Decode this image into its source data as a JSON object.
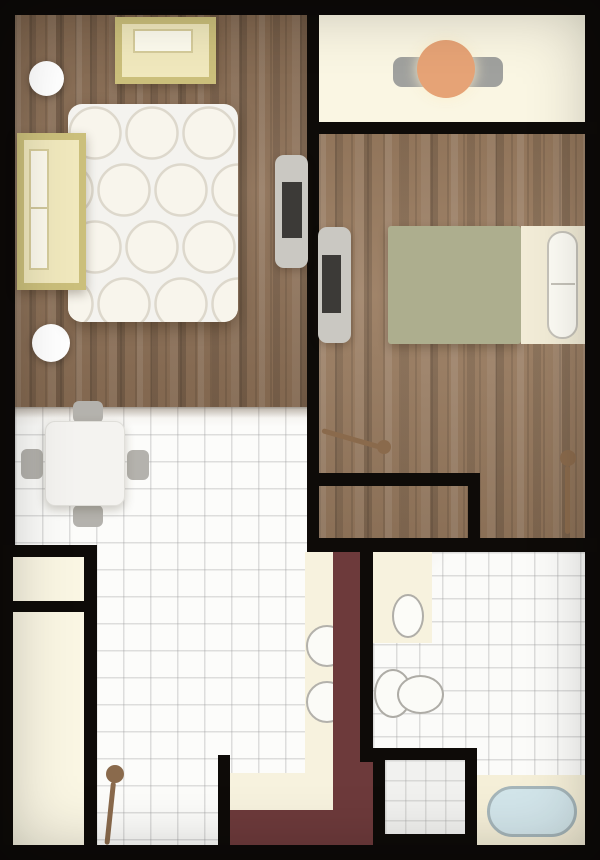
{
  "canvas": {
    "width": 600,
    "height": 860,
    "frame_color": "#0d0a08"
  },
  "palette": {
    "wall": "#0e0b08",
    "wood_living": "#8d7056",
    "wood_bedroom": "#9a7c60",
    "tile": "#fcfcfa",
    "cream_floor": "#faf6e3",
    "counter_cream": "#f7f2de",
    "accent_maroon": "#6d3a3b",
    "furniture_yellow": "#f0e8bd",
    "furniture_yellow_trim": "#cbbf7b",
    "blanket_olive": "#adae8e",
    "table_orange": "#e6a376",
    "gray_seat": "#a0a19e",
    "tv_gray": "#cac8c2",
    "tv_screen": "#3c3a37",
    "tub_blue": "#d2e5ea",
    "door_brown": "#8a6a4c"
  },
  "elements": [
    {
      "name": "living-room-floor",
      "class": "wood-a",
      "x": 15,
      "y": 15,
      "w": 292,
      "h": 392
    },
    {
      "name": "kitchen-dining-floor",
      "class": "tile-a",
      "x": 15,
      "y": 407,
      "w": 358,
      "h": 438
    },
    {
      "name": "wood-tile-transition-shadow",
      "x": 15,
      "y": 407,
      "w": 292,
      "h": 11,
      "fill": "linear-gradient(180deg, rgba(60,40,20,0.30), rgba(60,40,20,0))"
    },
    {
      "name": "balcony-floor",
      "x": 319,
      "y": 15,
      "w": 266,
      "h": 107,
      "fill": "#faf6e3"
    },
    {
      "name": "bedroom-floor",
      "class": "wood-b",
      "x": 319,
      "y": 134,
      "w": 266,
      "h": 404
    },
    {
      "name": "bathroom-floor",
      "class": "tile-b",
      "x": 373,
      "y": 552,
      "w": 212,
      "h": 293
    },
    {
      "name": "closet-block-walls",
      "x": 3,
      "y": 545,
      "w": 94,
      "h": 300,
      "fill": "#0e0b08"
    },
    {
      "name": "closet-upper-interior",
      "x": 13,
      "y": 557,
      "w": 71,
      "h": 44,
      "fill": "#faf6e3"
    },
    {
      "name": "closet-lower-interior",
      "x": 13,
      "y": 612,
      "w": 71,
      "h": 233,
      "fill": "#faf6e3"
    },
    {
      "name": "kitchen-counter-vertical",
      "x": 305,
      "y": 552,
      "w": 28,
      "h": 260,
      "fill": "#f7f2de"
    },
    {
      "name": "kitchen-counter-horizontal",
      "x": 230,
      "y": 773,
      "w": 103,
      "h": 39,
      "fill": "#f7f2de"
    },
    {
      "name": "kitchen-sink-basin-upper",
      "x": 306,
      "y": 625,
      "w": 42,
      "h": 42,
      "fill": "#fbfbf7",
      "border": "2.5px solid #b3b1ab",
      "radius": "50%"
    },
    {
      "name": "kitchen-sink-basin-lower",
      "x": 306,
      "y": 681,
      "w": 42,
      "h": 42,
      "fill": "#fbfbf7",
      "border": "2.5px solid #b3b1ab",
      "radius": "50%"
    },
    {
      "name": "accent-wall-vertical",
      "x": 333,
      "y": 552,
      "w": 27,
      "h": 293,
      "fill": "#6d3a3b"
    },
    {
      "name": "accent-wall-horizontal",
      "x": 230,
      "y": 810,
      "w": 130,
      "h": 35,
      "fill": "#6d3a3b"
    },
    {
      "name": "accent-wall-lower-patch",
      "x": 360,
      "y": 762,
      "w": 13,
      "h": 83,
      "fill": "#6d3a3b"
    },
    {
      "name": "wall-living-bedroom",
      "x": 307,
      "y": 15,
      "w": 12,
      "h": 537,
      "fill": "#0e0b08"
    },
    {
      "name": "wall-balcony-bottom",
      "x": 307,
      "y": 122,
      "w": 290,
      "h": 12,
      "fill": "#0e0b08"
    },
    {
      "name": "wall-bedroom-interior",
      "x": 319,
      "y": 473,
      "w": 161,
      "h": 13,
      "fill": "#0e0b08"
    },
    {
      "name": "wall-alcove-right",
      "x": 468,
      "y": 486,
      "w": 12,
      "h": 66,
      "fill": "#0e0b08"
    },
    {
      "name": "wall-south-of-bedroom",
      "x": 307,
      "y": 538,
      "w": 290,
      "h": 14,
      "fill": "#0e0b08"
    },
    {
      "name": "wall-bathroom-left",
      "x": 360,
      "y": 552,
      "w": 13,
      "h": 210,
      "fill": "#0e0b08"
    },
    {
      "name": "wall-entry",
      "x": 218,
      "y": 755,
      "w": 12,
      "h": 90,
      "fill": "#0e0b08"
    },
    {
      "name": "shower-enclosure",
      "x": 373,
      "y": 748,
      "w": 104,
      "h": 97,
      "fill": "#0e0b08"
    },
    {
      "name": "shower-tray",
      "class": "tile-c",
      "x": 385,
      "y": 760,
      "w": 80,
      "h": 74
    },
    {
      "name": "bathroom-counter",
      "x": 373,
      "y": 552,
      "w": 59,
      "h": 91,
      "fill": "#f7f2de"
    },
    {
      "name": "bathroom-sink",
      "x": 392,
      "y": 594,
      "w": 32,
      "h": 44,
      "fill": "#fcfcf8",
      "border": "2.5px solid #b0aea8",
      "radius": "50%"
    },
    {
      "name": "toilet-bowl",
      "x": 374,
      "y": 669,
      "w": 38,
      "h": 49,
      "fill": "#fbfbf7",
      "border": "2.5px solid #aeaca6",
      "radius": "50%"
    },
    {
      "name": "toilet-tank",
      "x": 397,
      "y": 675,
      "w": 47,
      "h": 39,
      "fill": "#fbfbf7",
      "border": "2.5px solid #aeaca6",
      "radius": "50%"
    },
    {
      "name": "bathtub-surround",
      "x": 477,
      "y": 775,
      "w": 108,
      "h": 70,
      "fill": "#f5efd8"
    },
    {
      "name": "bathtub",
      "x": 487,
      "y": 786,
      "w": 90,
      "h": 51,
      "fill": "#d2e5ea",
      "border": "3px solid #a6b6ba",
      "radius": "26px"
    },
    {
      "name": "bedroom-bed-blanket",
      "x": 388,
      "y": 226,
      "w": 133,
      "h": 118,
      "fill": "#adae8e",
      "radius": "3px",
      "shadow": "0 4px 10px rgba(40,25,10,0.28)"
    },
    {
      "name": "bedroom-bed-headboard",
      "x": 521,
      "y": 226,
      "w": 64,
      "h": 118,
      "fill": "#f2ecd7"
    },
    {
      "name": "bedroom-bed-pillow",
      "x": 547,
      "y": 231,
      "w": 31,
      "h": 108,
      "fill": "#fdfcf5",
      "border": "2px solid #c6c3ba",
      "radius": "15px"
    },
    {
      "name": "bedroom-bed-pillow-divider",
      "x": 551,
      "y": 283,
      "w": 24,
      "h": 2,
      "fill": "#c6c3ba"
    },
    {
      "name": "bedroom-tv-body",
      "x": 318,
      "y": 227,
      "w": 33,
      "h": 116,
      "fill": "#cac8c2",
      "radius": "9px",
      "shadow": "0 3px 8px rgba(40,25,10,0.25)"
    },
    {
      "name": "bedroom-tv-screen",
      "x": 322,
      "y": 255,
      "w": 19,
      "h": 58,
      "fill": "#3c3a37"
    },
    {
      "name": "bedroom-door-leaf",
      "x": 322,
      "y": 428,
      "w": 64,
      "h": 5,
      "fill": "#8a6a4c",
      "radius": "3px",
      "rotate": 16,
      "origin": "left center"
    },
    {
      "name": "bedroom-door-knob",
      "x": 377,
      "y": 440,
      "w": 14,
      "h": 14,
      "fill": "#8a6a4c",
      "radius": "50%"
    },
    {
      "name": "bedroom-door2-leaf",
      "x": 565,
      "y": 466,
      "w": 5,
      "h": 68,
      "fill": "#8a6a4c",
      "radius": "3px"
    },
    {
      "name": "bedroom-door2-knob",
      "x": 560,
      "y": 450,
      "w": 16,
      "h": 16,
      "fill": "#8a6a4c",
      "radius": "50%"
    },
    {
      "name": "balcony-chairs",
      "x": 393,
      "y": 57,
      "w": 110,
      "h": 30,
      "fill": "#a0a19e",
      "radius": "9px"
    },
    {
      "name": "balcony-round-table",
      "x": 417,
      "y": 40,
      "w": 58,
      "h": 58,
      "fill": "#e6a376",
      "radius": "50%",
      "shadow": "0 0 14px rgba(250,238,205,0.95)"
    },
    {
      "name": "living-lamp-upper",
      "x": 29,
      "y": 61,
      "w": 35,
      "h": 35,
      "fill": "#ffffff",
      "radius": "50%",
      "shadow": "0 2px 8px rgba(0,0,0,0.28)"
    },
    {
      "name": "living-lamp-lower",
      "x": 32,
      "y": 324,
      "w": 38,
      "h": 38,
      "fill": "#ffffff",
      "radius": "50%",
      "shadow": "0 2px 8px rgba(0,0,0,0.28)"
    },
    {
      "name": "living-bed",
      "x": 68,
      "y": 104,
      "w": 170,
      "h": 218,
      "fill": "#f4f3ef",
      "radius": "14px",
      "texture": "circles",
      "shadow": "0 6px 16px rgba(40,25,10,0.35)"
    },
    {
      "name": "wardrobe",
      "x": 17,
      "y": 133,
      "w": 69,
      "h": 157,
      "fill": "#f0e8bd",
      "border": "7px solid #cbbf7b",
      "shadow": "0 4px 10px rgba(40,25,10,0.30)"
    },
    {
      "name": "wardrobe-door-panel",
      "x": 29,
      "y": 149,
      "w": 20,
      "h": 121,
      "fill": "#fcf9ec",
      "border": "2px solid #d6cc9b"
    },
    {
      "name": "wardrobe-panel-divider",
      "x": 31,
      "y": 207,
      "w": 16,
      "h": 2,
      "fill": "#d0c79b"
    },
    {
      "name": "nightstand",
      "x": 115,
      "y": 17,
      "w": 101,
      "h": 67,
      "fill": "#f0e8bd",
      "border": "7px solid #cbbf7b",
      "shadow": "0 4px 10px rgba(40,25,10,0.30)"
    },
    {
      "name": "nightstand-drawer",
      "x": 133,
      "y": 29,
      "w": 60,
      "h": 24,
      "fill": "#fdfbee",
      "border": "2px solid #d6cc9b"
    },
    {
      "name": "living-tv-body",
      "x": 275,
      "y": 155,
      "w": 33,
      "h": 113,
      "fill": "#cac8c2",
      "radius": "9px",
      "shadow": "0 3px 8px rgba(40,25,10,0.25)"
    },
    {
      "name": "living-tv-screen",
      "x": 282,
      "y": 182,
      "w": 20,
      "h": 56,
      "fill": "#3c3a37"
    },
    {
      "name": "dining-chair-top",
      "x": 73,
      "y": 401,
      "w": 30,
      "h": 22,
      "fill": "#b4b2ad",
      "radius": "6px"
    },
    {
      "name": "dining-chair-bottom",
      "x": 73,
      "y": 505,
      "w": 30,
      "h": 22,
      "fill": "#b4b2ad",
      "radius": "6px"
    },
    {
      "name": "dining-chair-left",
      "x": 21,
      "y": 449,
      "w": 22,
      "h": 30,
      "fill": "#b4b2ad",
      "radius": "6px"
    },
    {
      "name": "dining-chair-right",
      "x": 127,
      "y": 450,
      "w": 22,
      "h": 30,
      "fill": "#b4b2ad",
      "radius": "6px"
    },
    {
      "name": "dining-table",
      "x": 45,
      "y": 421,
      "w": 80,
      "h": 85,
      "fill": "#f4f3f0",
      "radius": "10px",
      "border": "1px solid #e0dfda",
      "shadow": "0 4px 10px rgba(60,50,30,0.25)"
    },
    {
      "name": "entry-door-knob",
      "x": 106,
      "y": 765,
      "w": 18,
      "h": 18,
      "fill": "#8a6a4c",
      "radius": "50%"
    },
    {
      "name": "entry-door-leaf",
      "x": 111,
      "y": 782,
      "w": 5,
      "h": 63,
      "fill": "#8a6a4c",
      "radius": "3px",
      "rotate": 6,
      "origin": "50% 0"
    }
  ]
}
